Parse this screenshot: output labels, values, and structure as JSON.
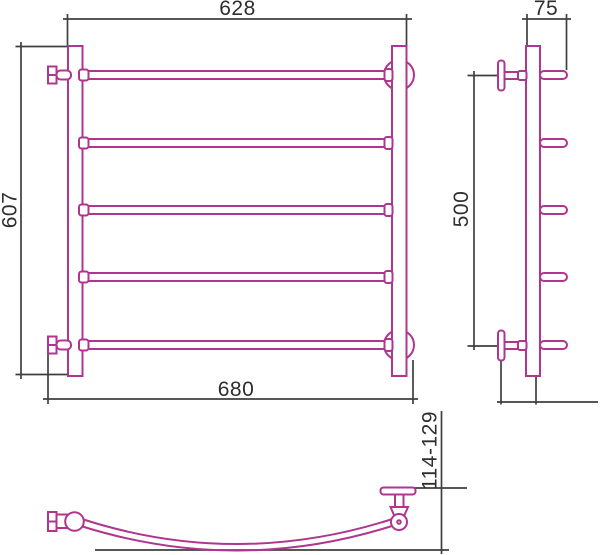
{
  "drawing": {
    "colors": {
      "outline": "#b0358f",
      "dimension_line": "#3f3f3f",
      "label_text": "#2e2e2e",
      "background": "#ffffff"
    },
    "dimensions": {
      "front_top_width": "628",
      "front_height": "607",
      "front_bottom_width": "680",
      "side_depth": "75",
      "side_mount_height": "500",
      "wall_clearance_range": "114-129"
    },
    "front_view": {
      "rung_count": 5
    },
    "side_view": {
      "stub_count": 5,
      "flange_count": 2
    },
    "top_view": {
      "curved_rail_count": 1
    }
  }
}
